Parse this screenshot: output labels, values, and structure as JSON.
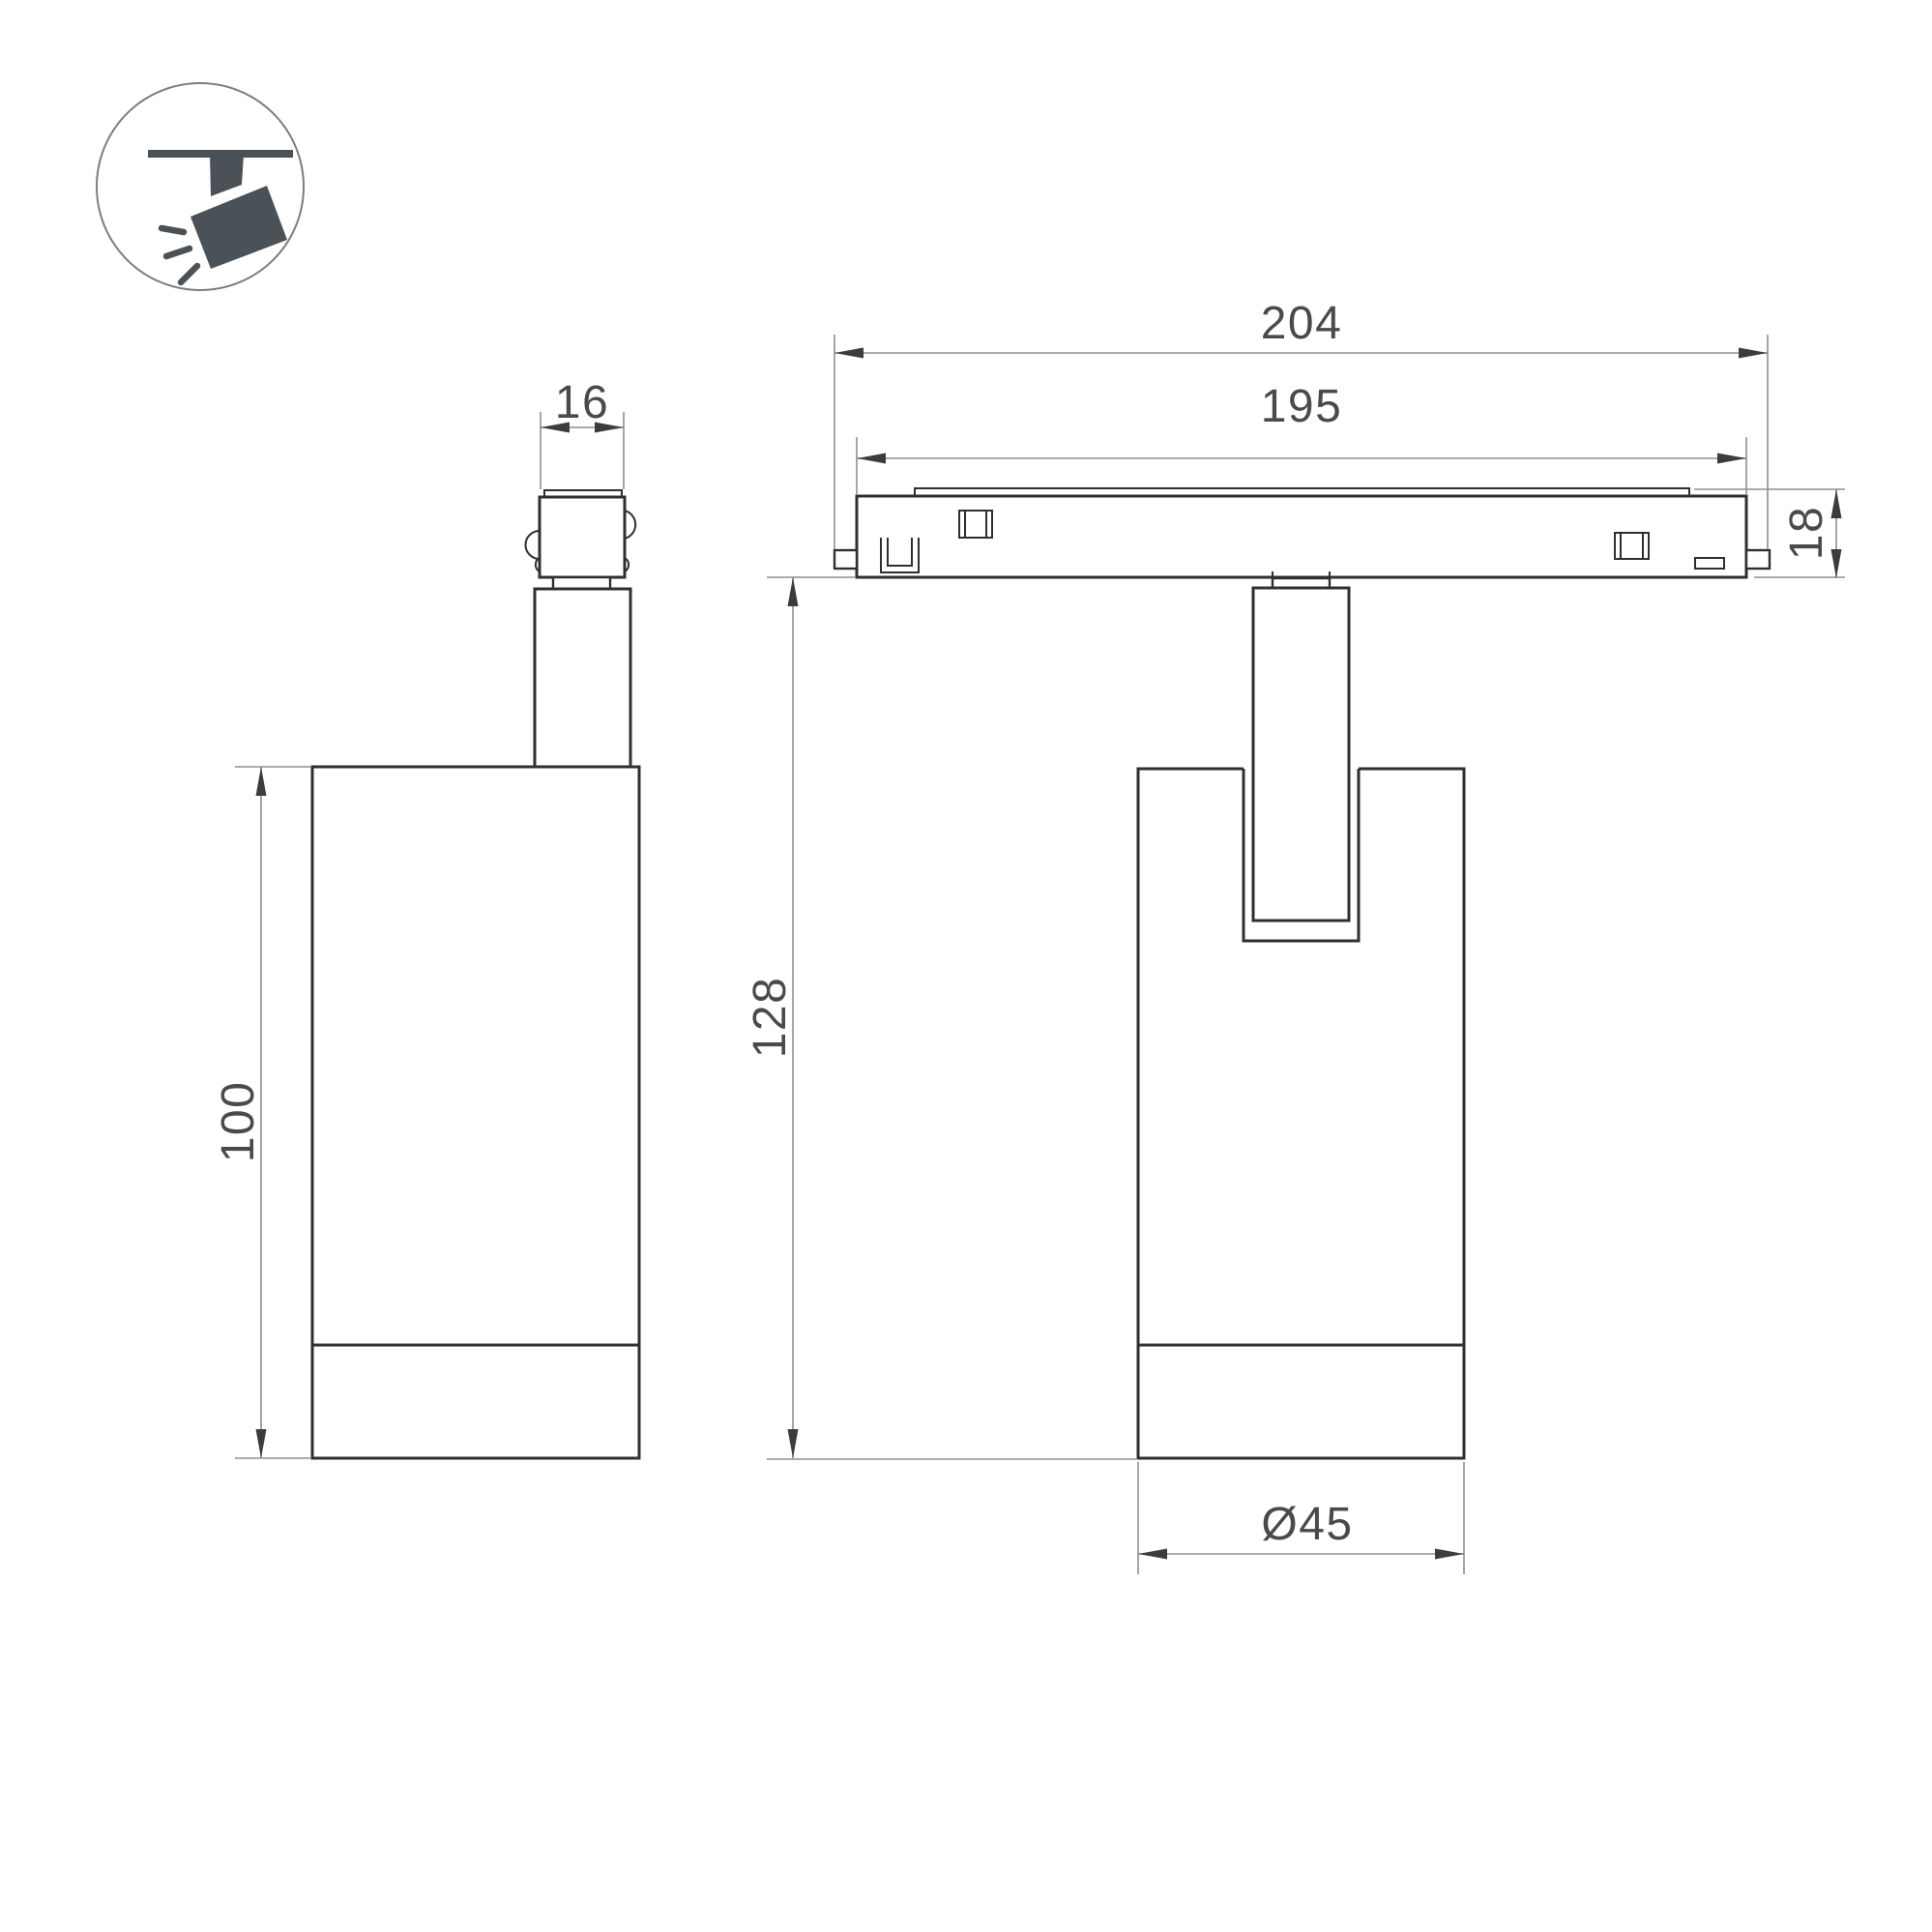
{
  "icon": {
    "name": "ceiling-track-spotlight-pictogram",
    "glyph_color": "#4B5257",
    "ring_color": "#7A7E80"
  },
  "dimensions": {
    "adapter_width": "16",
    "track_overall_length": "204",
    "track_body_length": "195",
    "track_height": "18",
    "housing_height": "100",
    "overall_height": "128",
    "housing_diameter": "Ø45"
  },
  "colors": {
    "outline": "#2D2F31",
    "dimension_line": "#8E9090",
    "dimension_text": "#4A4A4A",
    "background": "#FFFFFF"
  }
}
